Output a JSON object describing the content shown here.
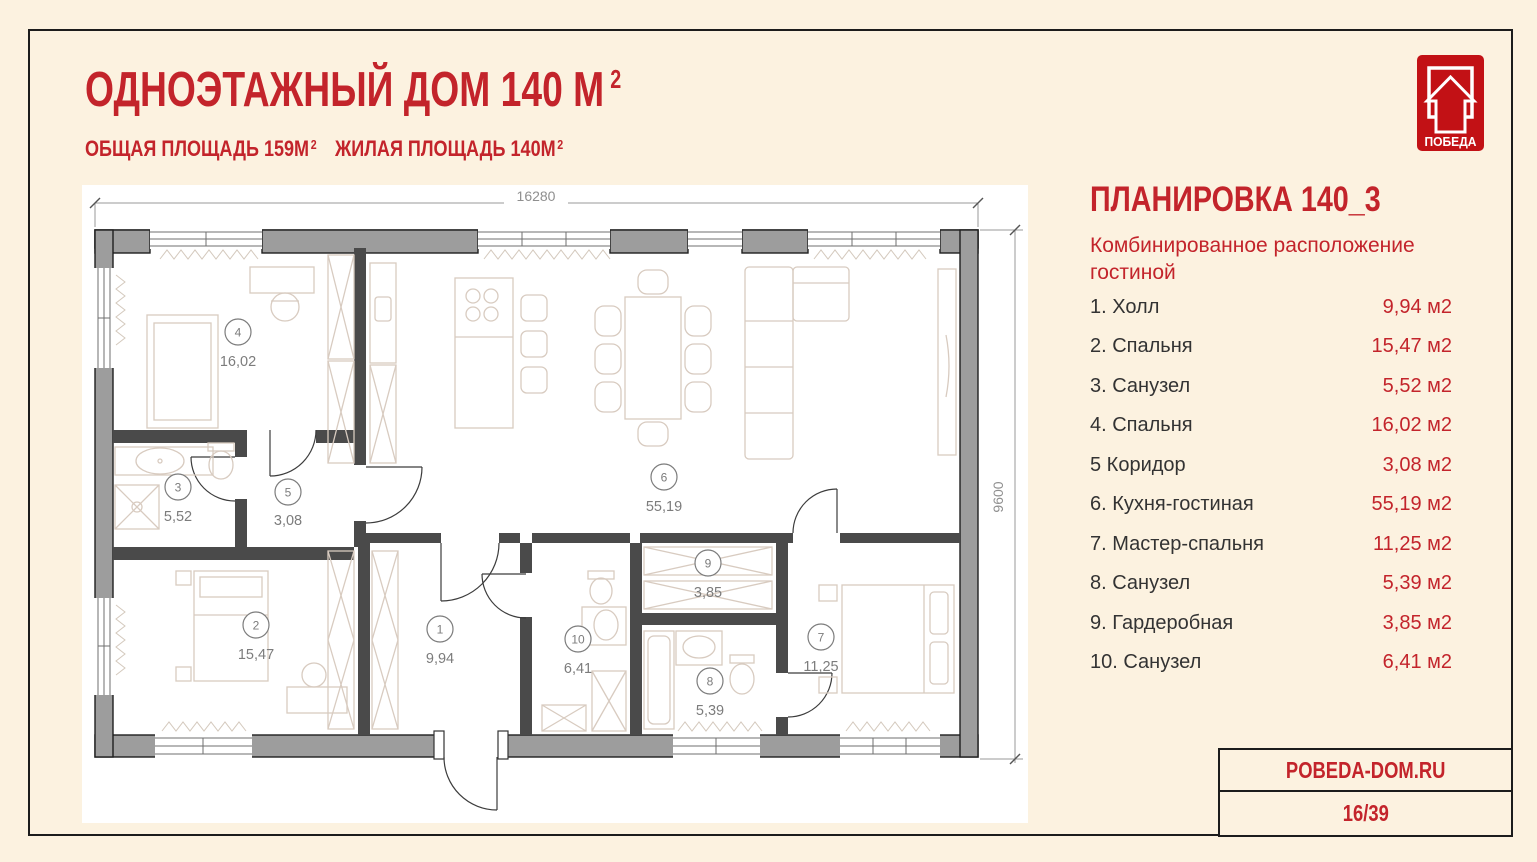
{
  "header": {
    "title": "ОДНОЭТАЖНЫЙ ДОМ 140 М",
    "title_sup": "2",
    "total_area": "ОБЩАЯ ПЛОЩАДЬ 159М",
    "total_area_sup": "2",
    "living_area": "ЖИЛАЯ ПЛОЩАДЬ 140М",
    "living_area_sup": "2"
  },
  "logo": {
    "text": "ПОБЕДА"
  },
  "panel": {
    "title": "ПЛАНИРОВКА 140_3",
    "subtitle": "Комбинированное расположение гостиной",
    "rooms": [
      {
        "label": "1. Холл",
        "area": "9,94 м2"
      },
      {
        "label": "2. Спальня",
        "area": "15,47 м2"
      },
      {
        "label": "3. Санузел",
        "area": "5,52 м2"
      },
      {
        "label": "4. Спальня",
        "area": "16,02 м2"
      },
      {
        "label": "5 Коридор",
        "area": "3,08 м2"
      },
      {
        "label": "6. Кухня-гостиная",
        "area": "55,19 м2"
      },
      {
        "label": "7. Мастер-спальня",
        "area": "11,25 м2"
      },
      {
        "label": "8. Санузел",
        "area": "5,39 м2"
      },
      {
        "label": "9. Гардеробная",
        "area": "3,85 м2"
      },
      {
        "label": "10. Санузел",
        "area": "6,41 м2"
      }
    ]
  },
  "plan": {
    "dims": {
      "width": "16280",
      "height": "9600"
    },
    "rooms": [
      {
        "num": "1",
        "area": "9,94"
      },
      {
        "num": "2",
        "area": "15,47"
      },
      {
        "num": "3",
        "area": "5,52"
      },
      {
        "num": "4",
        "area": "16,02"
      },
      {
        "num": "5",
        "area": "3,08"
      },
      {
        "num": "6",
        "area": "55,19"
      },
      {
        "num": "7",
        "area": "11,25"
      },
      {
        "num": "8",
        "area": "5,39"
      },
      {
        "num": "9",
        "area": "3,85"
      },
      {
        "num": "10",
        "area": "6,41"
      }
    ]
  },
  "footer": {
    "website": "POBEDA-DOM.RU",
    "page_number": "16/39"
  },
  "colors": {
    "accent_red": "#c3242b",
    "logo_red": "#c21115",
    "background_cream": "#fcf2e0",
    "wall_gray": "#9d9d9d",
    "plan_white": "#ffffff"
  }
}
